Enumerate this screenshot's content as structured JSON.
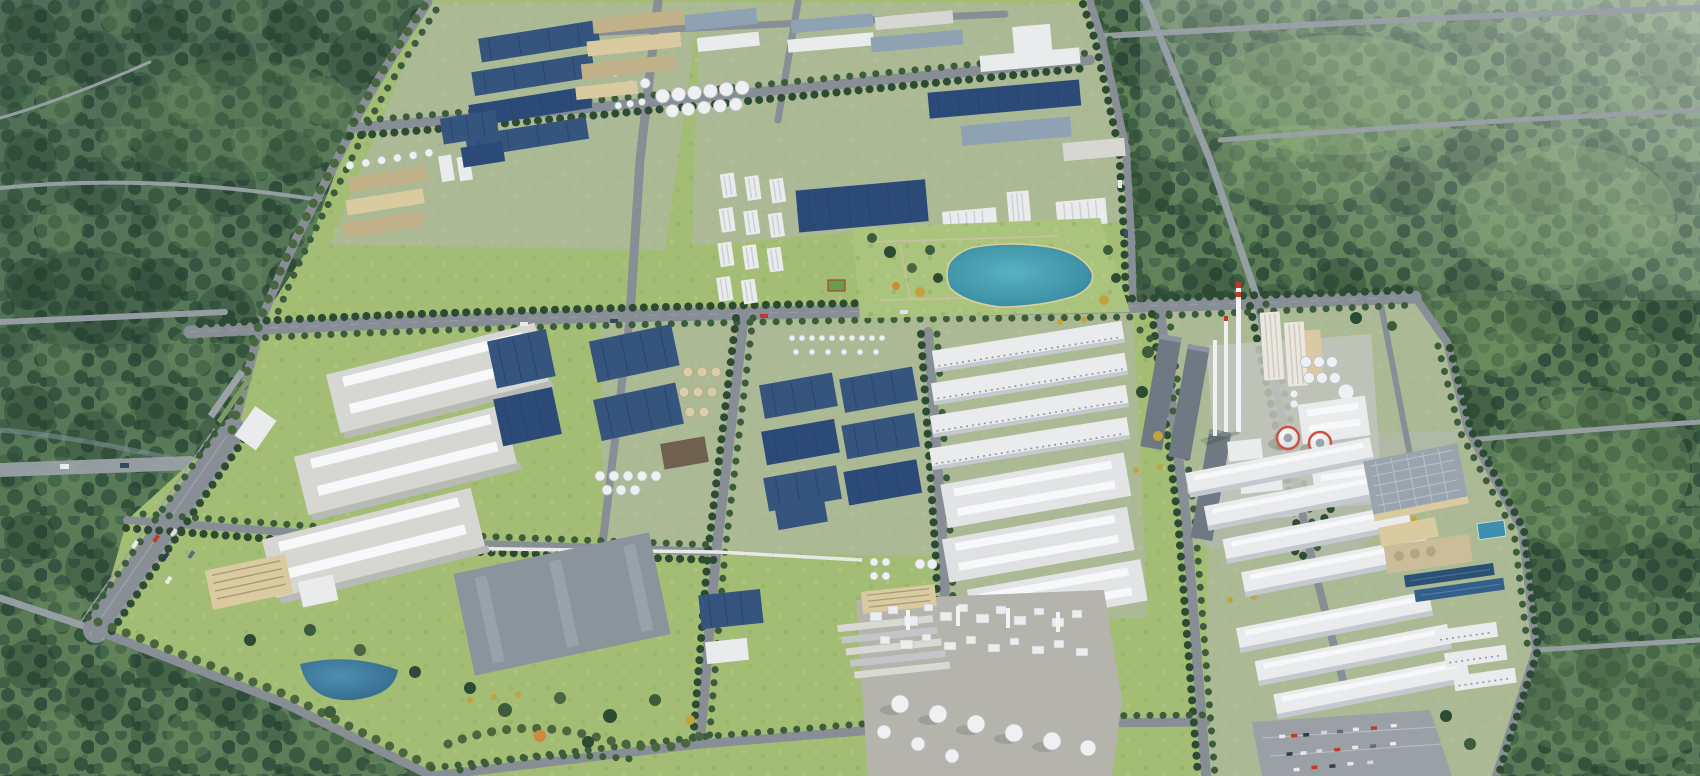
{
  "meta": {
    "title": "Industrial park aerial rendering",
    "description": "Bird's-eye 3D rendering of a large industrial park surrounded by dense evergreen forest: blue-roof factory halls, tan workshops, white tank farms, a landscaped central lake with white office blocks, a cement and power plant with tall chimneys and two red-ringed cooling towers, a chemical plant with round stacks, long white warehouses, tree-lined roads, a multi-lane boulevard and car parking lots."
  },
  "palette": {
    "forest_dark": "#32523f",
    "forest_base": "#5c7d58",
    "glade": "#7fa066",
    "park_lawn": "#a3bd74",
    "road": "#878e95",
    "roof_blue": "#35547e",
    "roof_white": "#e9ebed",
    "roof_gray": "#d6d7d3",
    "wall_tan": "#d9caa0",
    "lake": "#3f93a8",
    "pool_blue": "#2d5a82",
    "cooling_ring": "#cd5242",
    "tree": "#2d4b33",
    "accent_tree": "#c2a43e"
  },
  "regions": {
    "scene": {
      "label": "Aerial view of industrial park in forest"
    },
    "forest": {
      "label": "Surrounding evergreen forest with clearings and rural roads"
    },
    "park": {
      "label": "Industrial park grounds with road grid and tree lines"
    },
    "factoriesNW": {
      "label": "North-west factories with blue roofs, tan workshops and tank farm"
    },
    "factoriesN": {
      "label": "Northern factory rows with spherical tanks"
    },
    "factoriesNE": {
      "label": "North-east factories with solar roofs and office towers"
    },
    "dorms": {
      "label": "White staff buildings with sports court"
    },
    "lakeGarden": {
      "label": "Landscaped garden with central lake"
    },
    "lake": {
      "label": "Central lake"
    },
    "warehousesSW": {
      "label": "South-west large light-gray warehouses, office and pond"
    },
    "boulevard": {
      "label": "Tree-lined multi-lane boulevard with parked cars"
    },
    "factoriesC": {
      "label": "Central blue-roof warehouses with silo clusters"
    },
    "warehousesC": {
      "label": "Central-east white ribbed production halls"
    },
    "cementPlant": {
      "label": "Cement and power plant with chimneys, silos and cooling towers"
    },
    "coolingTowers": {
      "label": "Two cooling towers with red rims"
    },
    "chimneys": {
      "label": "Tall white chimneys"
    },
    "chemicalPlant": {
      "label": "Chemical plant with columns and round stacks"
    },
    "pipeRack": {
      "label": "Elevated pipe rack corridor"
    },
    "warehousesSE": {
      "label": "South-east rows of long white warehouses"
    },
    "treatment": {
      "label": "Water treatment pools"
    },
    "parking": {
      "label": "Parking lot with cars"
    }
  },
  "scene_facts": {
    "cooling_towers": 2,
    "tall_chimneys": 3,
    "central_lakes": 1,
    "sw_large_warehouses": 3,
    "se_warehouse_rows": 7,
    "spherical_tanks_row": 11
  }
}
